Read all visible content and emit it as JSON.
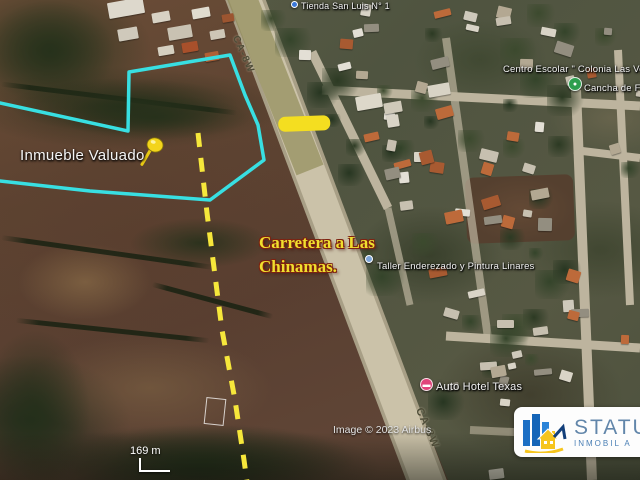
{
  "map": {
    "poi_labels": {
      "tienda": "Tienda San Luis N° 1",
      "centro_escolar": "Centro Escolar \" Colonia Las Ve",
      "cancha": "Cancha de F",
      "taller": "Taller Enderezado y Pintura Linares",
      "auto_hotel": "Auto Hotel Texas"
    },
    "road_labels": {
      "top": "CA-8W",
      "bottom": "CA-8W"
    },
    "annotations": {
      "parcel_label": "Inmueble Valuado",
      "road_note_line1": "Carretera a Las",
      "road_note_line2": "Chinamas.",
      "colors": {
        "parcel_outline": "#38dfe2",
        "dashed_line": "#f6e73b",
        "highlight_bar": "#f4de20",
        "road_note_text": "#f0df2e",
        "pushpin": "#f3d41c"
      }
    },
    "attribution": "Image © 2023 Airbus",
    "scale": {
      "label": "169 m"
    },
    "icons": {
      "tienda_marker": "place-dot-icon",
      "cancha_marker": "sports-field-icon",
      "taller_marker": "place-dot-icon",
      "auto_hotel_marker": "hotel-icon",
      "parcel_pin": "pushpin-icon"
    }
  },
  "logo": {
    "brand": "STATU",
    "subtitle": "INMOBIL A",
    "colors": {
      "buildings_blue": "#1b6cc0",
      "house_yellow": "#f6c51d",
      "text_blue": "#6286aa",
      "subtext_blue": "#4a7fb5",
      "background": "#ffffff"
    }
  }
}
